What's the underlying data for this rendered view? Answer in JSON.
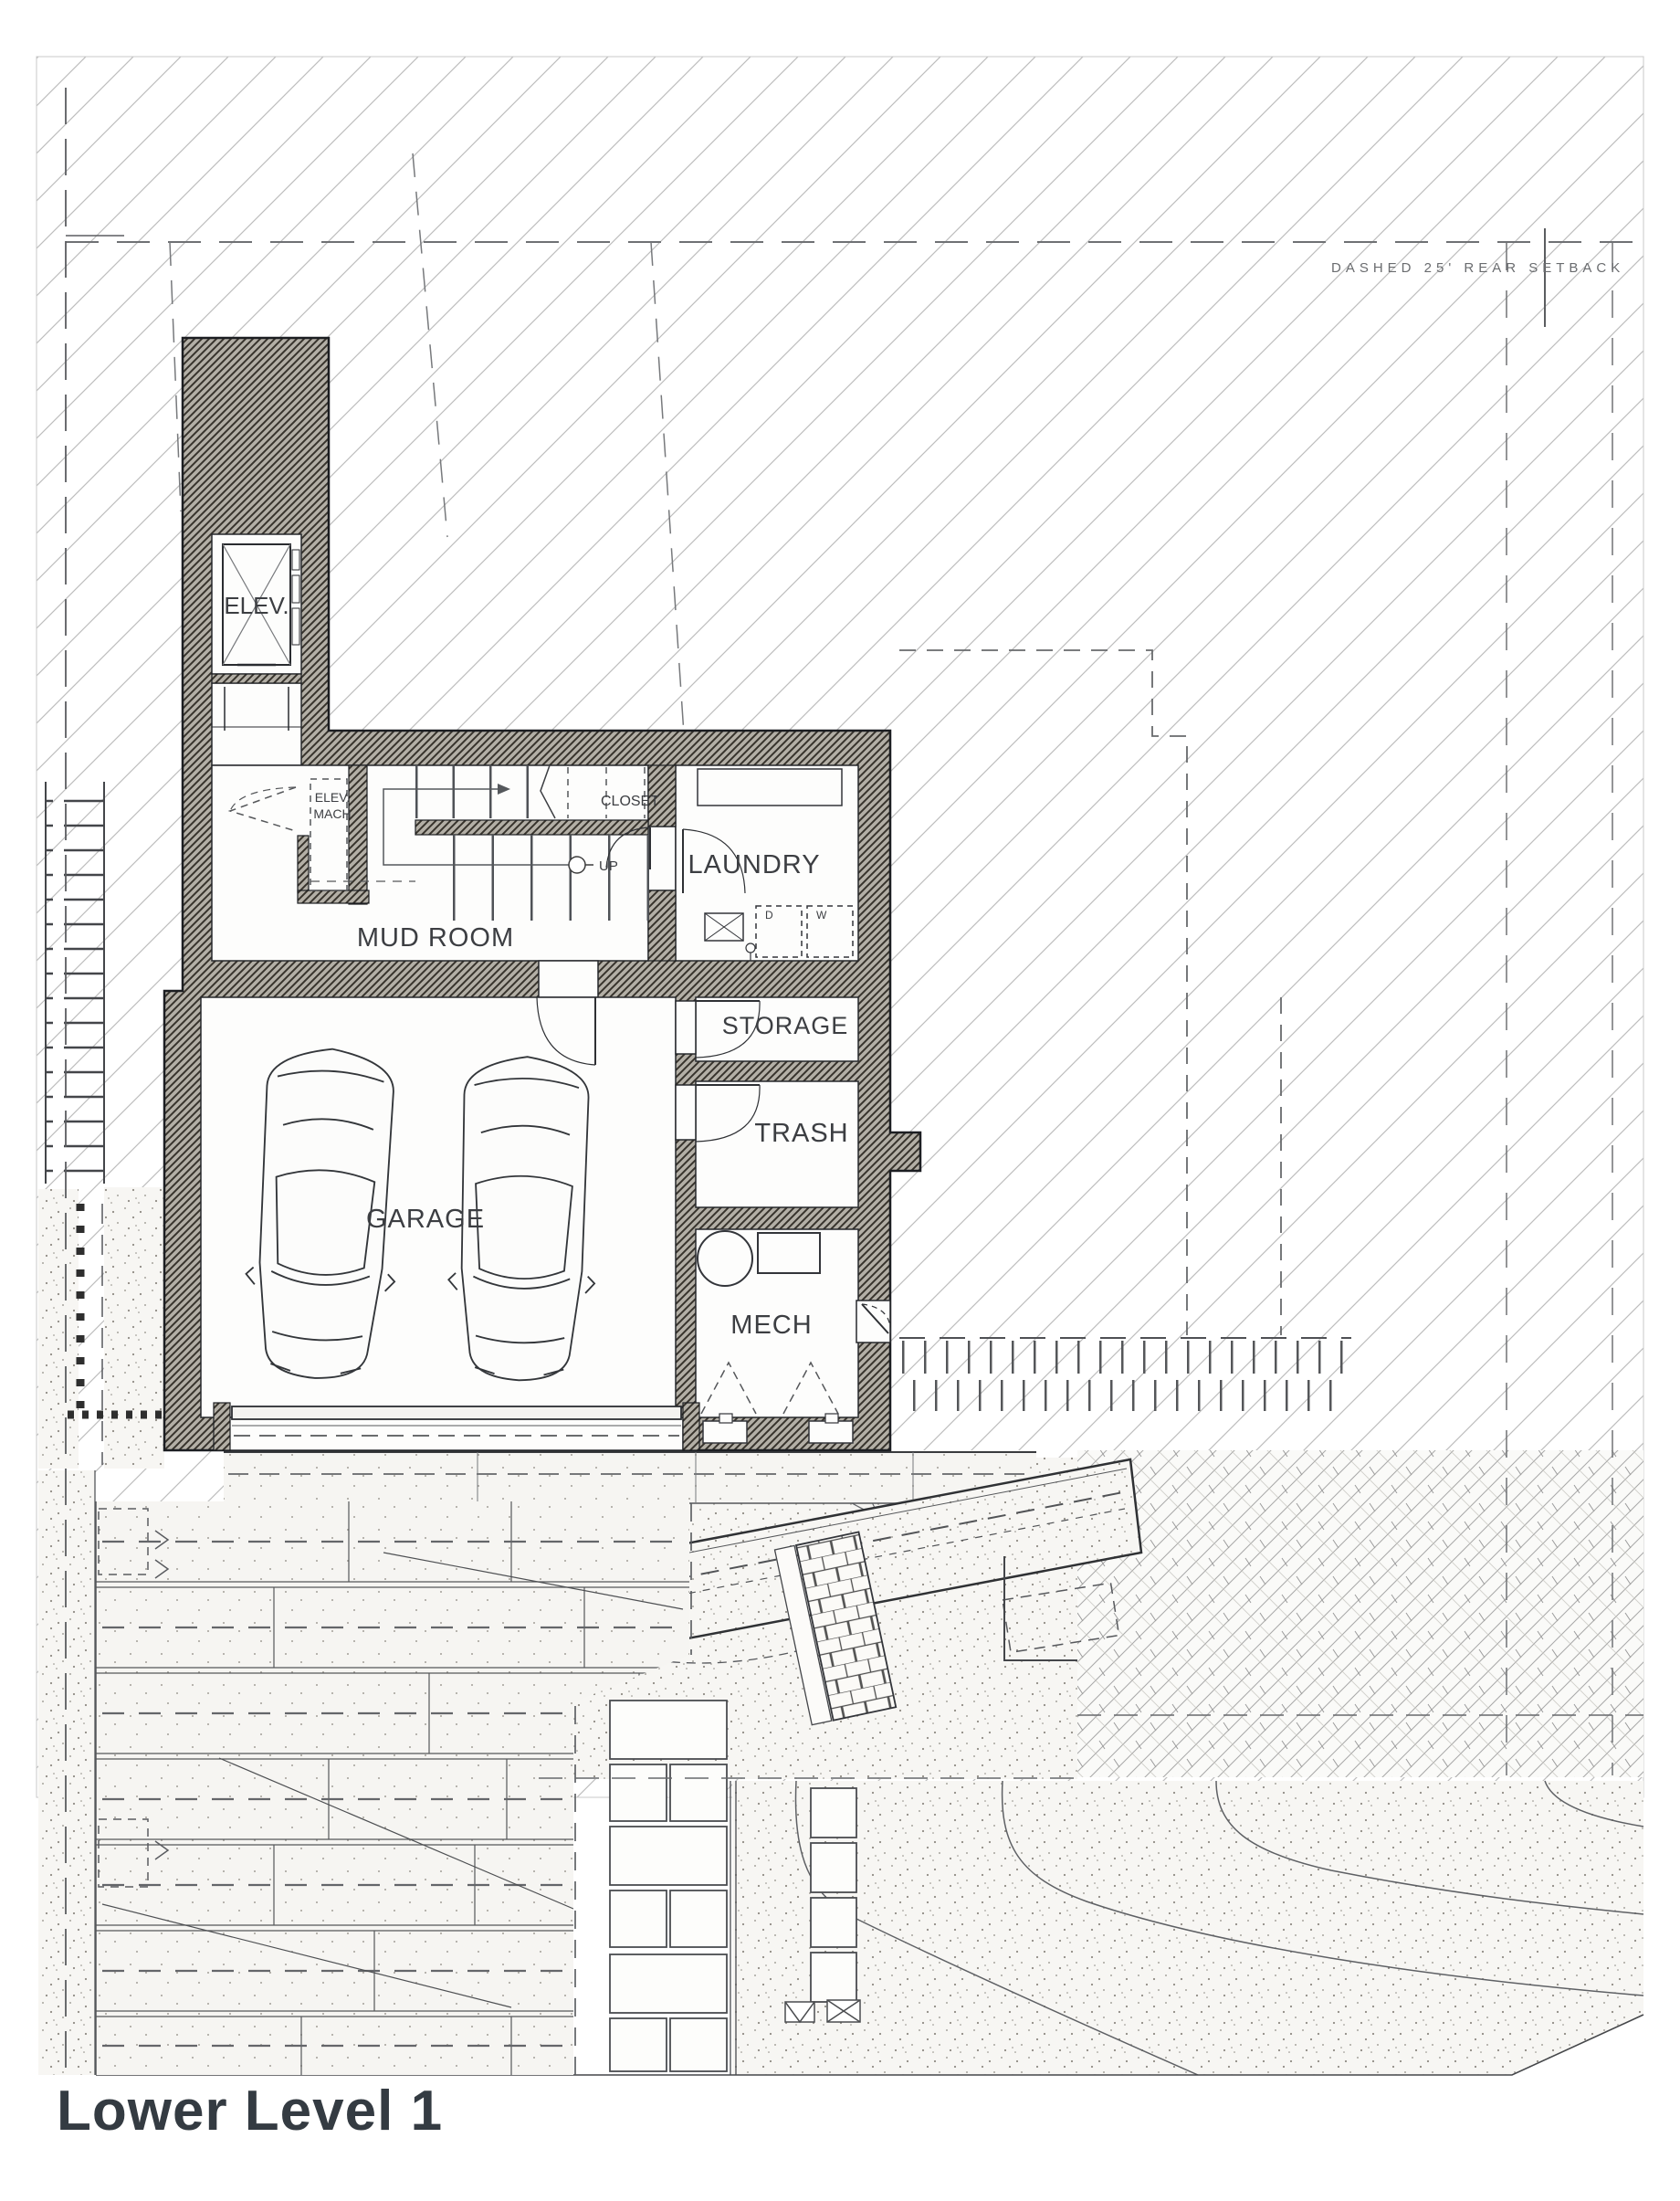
{
  "title": "Lower Level 1",
  "site": {
    "rear_setback_note": "DASHED 25' REAR SETBACK"
  },
  "rooms": {
    "elevator": "ELEV.",
    "elev_mach_line1": "ELEV.",
    "elev_mach_line2": "MACH",
    "closet": "CLOSET",
    "mud_room": "MUD ROOM",
    "laundry": "LAUNDRY",
    "storage": "STORAGE",
    "trash": "TRASH",
    "garage": "GARAGE",
    "mech": "MECH"
  },
  "stairs": {
    "direction_label": "UP"
  },
  "appliances": {
    "dryer": "D",
    "washer": "W"
  }
}
